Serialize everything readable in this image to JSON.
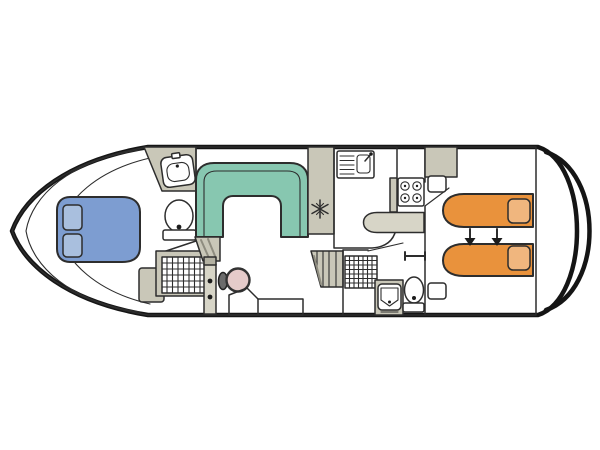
{
  "diagram": {
    "type": "houseboat-floor-plan",
    "orientation": "bow-left",
    "background": "#ffffff",
    "colors": {
      "hull_white": "#ffffff",
      "floor": "#eae6cb",
      "floor_light": "#f2efdd",
      "cabinet_gray": "#c9c7b8",
      "counter_gray": "#d7d5c7",
      "cap_gray": "#b3b1a2",
      "seat_teal": "#87c7b0",
      "bed_blue": "#7d9dd1",
      "pillow_blue": "#a9bfde",
      "bed_orange": "#e9923c",
      "pillow_orange": "#f0b67e",
      "wheel_pink": "#e5cbca",
      "outline_black": "#151515",
      "line_dark": "#2d2d2d"
    },
    "areas": [
      {
        "name": "bow-deck",
        "features": [
          "trim-lines"
        ]
      },
      {
        "name": "front-cabin",
        "features": [
          "double-bed",
          "two-pillows",
          "wardrobe"
        ]
      },
      {
        "name": "front-bathroom",
        "features": [
          "washbasin",
          "toilet",
          "shower-grid",
          "door"
        ]
      },
      {
        "name": "saloon",
        "features": [
          "u-shaped-dinette",
          "steps"
        ]
      },
      {
        "name": "galley",
        "features": [
          "sink-with-drainer",
          "fridge-snowflake",
          "hob-4-burner",
          "worktop"
        ]
      },
      {
        "name": "helm",
        "features": [
          "steering-wheel",
          "helm-seat"
        ]
      },
      {
        "name": "companionway",
        "features": [
          "stairs"
        ]
      },
      {
        "name": "rear-bathroom",
        "features": [
          "shower-grid",
          "washbasin",
          "toilet",
          "door"
        ]
      },
      {
        "name": "rear-cabin",
        "features": [
          "single-bed",
          "single-bed",
          "slide-together-arrows",
          "wardrobe",
          "shelves"
        ]
      },
      {
        "name": "stern-deck",
        "features": [
          "double-rail"
        ]
      }
    ]
  }
}
